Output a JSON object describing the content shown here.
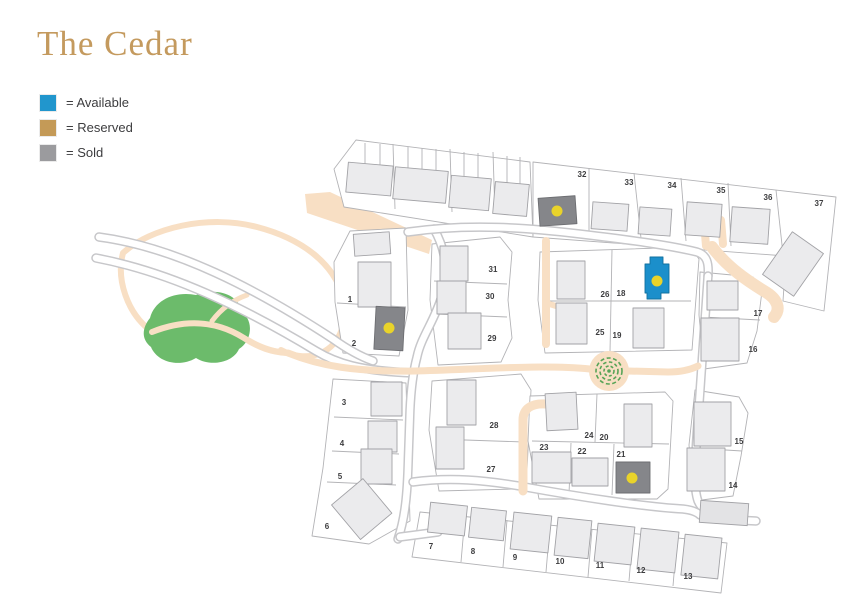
{
  "title": "The Cedar",
  "legend": [
    {
      "key": "available",
      "label": "= Available",
      "color": "#2196cd"
    },
    {
      "key": "reserved",
      "label": "= Reserved",
      "color": "#c49a57"
    },
    {
      "key": "sold",
      "label": "= Sold",
      "color": "#9b9b9e"
    }
  ],
  "colors": {
    "title": "#c49a5e",
    "available": "#1b8fcb",
    "reserved": "#c49a57",
    "sold": "#85868a",
    "marker": "#e9d32a",
    "path": "#f8dfc4",
    "green": "#6cbb6b"
  },
  "plots": [
    {
      "n": "1",
      "x": 350,
      "y": 302
    },
    {
      "n": "2",
      "x": 354,
      "y": 346
    },
    {
      "n": "3",
      "x": 344,
      "y": 405
    },
    {
      "n": "4",
      "x": 342,
      "y": 446
    },
    {
      "n": "5",
      "x": 340,
      "y": 479
    },
    {
      "n": "6",
      "x": 327,
      "y": 529
    },
    {
      "n": "7",
      "x": 431,
      "y": 549
    },
    {
      "n": "8",
      "x": 473,
      "y": 554
    },
    {
      "n": "9",
      "x": 515,
      "y": 560
    },
    {
      "n": "10",
      "x": 560,
      "y": 564
    },
    {
      "n": "11",
      "x": 600,
      "y": 568
    },
    {
      "n": "12",
      "x": 641,
      "y": 573
    },
    {
      "n": "13",
      "x": 688,
      "y": 579
    },
    {
      "n": "14",
      "x": 733,
      "y": 488
    },
    {
      "n": "15",
      "x": 739,
      "y": 444
    },
    {
      "n": "16",
      "x": 753,
      "y": 352
    },
    {
      "n": "17",
      "x": 758,
      "y": 316
    },
    {
      "n": "18",
      "x": 621,
      "y": 296
    },
    {
      "n": "19",
      "x": 617,
      "y": 338
    },
    {
      "n": "20",
      "x": 604,
      "y": 440
    },
    {
      "n": "21",
      "x": 621,
      "y": 457
    },
    {
      "n": "22",
      "x": 582,
      "y": 454
    },
    {
      "n": "23",
      "x": 544,
      "y": 450
    },
    {
      "n": "24",
      "x": 589,
      "y": 438
    },
    {
      "n": "25",
      "x": 600,
      "y": 335
    },
    {
      "n": "26",
      "x": 605,
      "y": 297
    },
    {
      "n": "27",
      "x": 491,
      "y": 472
    },
    {
      "n": "28",
      "x": 494,
      "y": 428
    },
    {
      "n": "29",
      "x": 492,
      "y": 341
    },
    {
      "n": "30",
      "x": 490,
      "y": 299
    },
    {
      "n": "31",
      "x": 493,
      "y": 272
    },
    {
      "n": "32",
      "x": 582,
      "y": 177
    },
    {
      "n": "33",
      "x": 629,
      "y": 185
    },
    {
      "n": "34",
      "x": 672,
      "y": 188
    },
    {
      "n": "35",
      "x": 721,
      "y": 193
    },
    {
      "n": "36",
      "x": 768,
      "y": 200
    },
    {
      "n": "37",
      "x": 819,
      "y": 206
    }
  ],
  "units": [
    {
      "plot": "2",
      "status": "sold"
    },
    {
      "plot": "18",
      "status": "available"
    },
    {
      "plot": "21",
      "status": "sold"
    },
    {
      "plot": "32",
      "status": "sold"
    }
  ]
}
